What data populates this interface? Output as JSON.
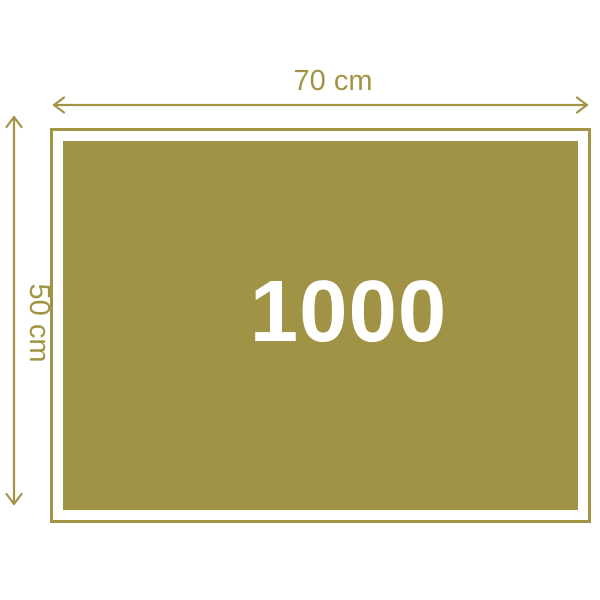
{
  "colors": {
    "accent": "#a29445",
    "fill": "#a09345",
    "number": "#ffffff",
    "background": "#ffffff"
  },
  "diagram": {
    "width_label": "70 cm",
    "height_label": "50 cm",
    "piece_count": "1000"
  }
}
